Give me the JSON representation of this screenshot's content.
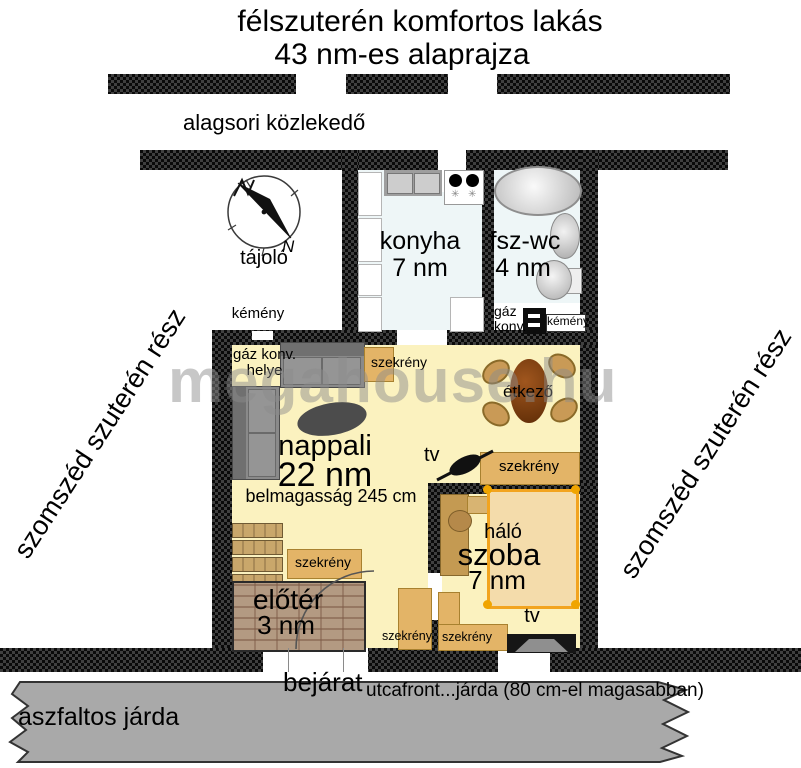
{
  "title": {
    "line1": "félszuterén komfortos lakás",
    "line2": "43 nm-es alaprajza"
  },
  "corridor_label": "alagsori közlekedő",
  "compass": {
    "label": "tájoló",
    "north": "N"
  },
  "rooms": {
    "kitchen": {
      "name": "konyha",
      "area": "7 nm"
    },
    "wc": {
      "name": "fsz-wc",
      "area": "4 nm"
    },
    "living": {
      "name": "nappali",
      "area": "22 nm",
      "ceiling": "belmagasság 245 cm"
    },
    "dining": {
      "name": "étkező"
    },
    "bedroom": {
      "name_line1": "háló",
      "name_line2": "szoba",
      "area": "7 nm"
    },
    "hall": {
      "name": "előtér",
      "area": "3 nm"
    }
  },
  "fixtures": {
    "chimney_left": "kémény",
    "chimney_right": "kémény",
    "gas_wc_line1": "gáz",
    "gas_wc_line2": "konv.",
    "gas_place_line1": "gáz konv.",
    "gas_place_line2": "helye",
    "cabinet": "szekrény",
    "tv_living": "tv",
    "tv_bedroom": "tv"
  },
  "outside": {
    "entrance": "bejárat",
    "street_note": "utcafront...járda (80 cm-el magasabban)",
    "sidewalk": "aszfaltos járda",
    "neighbor_left": "szomszéd szuterén rész",
    "neighbor_right": "szomszéd szuterén rész"
  },
  "watermark": "megahouse.hu",
  "colors": {
    "wall": "#141414",
    "floor_living": "#fbf2bf",
    "floor_wet": "#eef6f7",
    "cabinet": "#e3b467",
    "bed_border": "#f2a41f",
    "sidewalk": "#a9a9a9"
  }
}
